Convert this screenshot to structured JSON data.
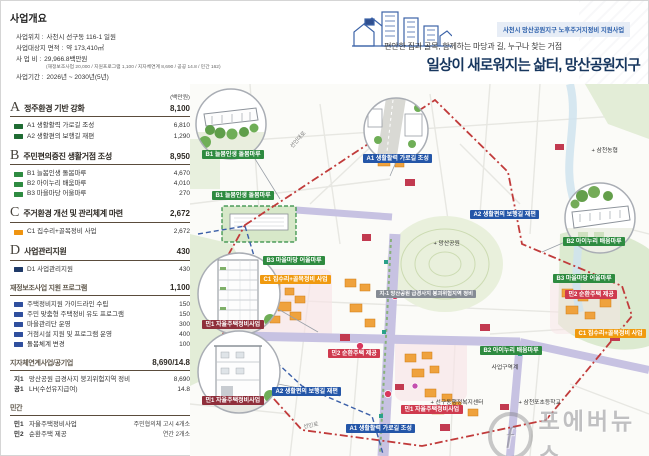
{
  "header": {
    "badge": "사천시 망산공원지구 노후주거지정비 지원사업",
    "subtitle": "편안한 집과 골목, 함께하는 마당과 길, 누구나 찾는 거점",
    "title": "일상이 새로워지는 삶터, 망산공원지구"
  },
  "overview": {
    "title": "사업개요",
    "rows": [
      {
        "label": "사업위치 :",
        "value": "사천시 선구동 116-1 일원"
      },
      {
        "label": "사업대상지 면적 :",
        "value": "약 173,410㎡"
      },
      {
        "label": "사 업 비 :",
        "value": "29,966.8백만원"
      },
      {
        "label": "사업기간 :",
        "value": "2026년 ~ 2030년(5년)"
      }
    ],
    "cost_note": "(재정보조사업 20,000 / 지원프로그램 1,100 / 지자체연계 8,690 / 공공 14.8 / 민간 162)"
  },
  "budget": {
    "unit": "(백만원)",
    "sections": [
      {
        "letter": "A",
        "title": "정주환경 기반 강화",
        "total": "8,100",
        "items": [
          {
            "label": "A1 생활활력 가로길 조성",
            "value": "6,810"
          },
          {
            "label": "A2 생활편의 보행길 재편",
            "value": "1,290"
          }
        ]
      },
      {
        "letter": "B",
        "title": "주민편의증진 생활거점 조성",
        "total": "8,950",
        "items": [
          {
            "label": "B1 늘봄인생 돌봄마루",
            "value": "4,670"
          },
          {
            "label": "B2 아이누리 배움마루",
            "value": "4,010"
          },
          {
            "label": "B3 마을마당 어울마루",
            "value": "270"
          }
        ]
      },
      {
        "letter": "C",
        "title": "주거환경 개선 및 관리체계 마련",
        "total": "2,672",
        "items": [
          {
            "label": "C1 집수리+골목정비 사업",
            "value": "2,672"
          }
        ]
      },
      {
        "letter": "D",
        "title": "사업관리지원",
        "total": "430",
        "items": [
          {
            "label": "D1 사업관리지원",
            "value": "430"
          }
        ]
      }
    ],
    "program": {
      "title": "재정보조사업 지원 프로그램",
      "total": "1,100",
      "items": [
        {
          "label": "주택정비지원 가이드라인 수립",
          "value": "150"
        },
        {
          "label": "주민 맞춤형 주택정비 유도 프로그램",
          "value": "150"
        },
        {
          "label": "마을관리단 운영",
          "value": "300"
        },
        {
          "label": "거점시설 지원 및 프로그램 운영",
          "value": "400"
        },
        {
          "label": "돌봄체계 변경",
          "value": "100"
        }
      ]
    },
    "linked": {
      "title": "지자체연계사업/공기업",
      "total": "8,690/14.8",
      "items": [
        {
          "code": "지1",
          "label": "망산공원 급경사지 붕괴위험지역 정비",
          "value": "8,690"
        },
        {
          "code": "공1",
          "label": "LH(수선유지급여)",
          "value": "14.8"
        }
      ]
    },
    "private": {
      "title": "민간",
      "items": [
        {
          "code": "민1",
          "label": "자율주택정비사업",
          "value": "주민협의체 고시 4개소"
        },
        {
          "code": "민2",
          "label": "순환주택 제공",
          "value": "연간 2개소"
        }
      ]
    }
  },
  "map": {
    "labels": [
      {
        "text": "B1 늘봄인생 돌봄마루"
      },
      {
        "text": "A1 생활활력 가로길 조성"
      },
      {
        "text": "B2 아이누리 배움마루"
      },
      {
        "text": "민1 자율주택정비사업"
      },
      {
        "text": "민1 자율주택정비사업"
      },
      {
        "text": "B1 늘봄인생 돌봄마루"
      },
      {
        "text": "B3 마을마당 어울마루"
      },
      {
        "text": "C1 집수리+골목정비 사업"
      },
      {
        "text": "민2 순환주택 제공"
      },
      {
        "text": "A2 생활편의 보행길 재편"
      },
      {
        "text": "A2 생활편의 보행길 재편"
      },
      {
        "text": "지-1 망산공원 급경사지 붕괴위험지역 정비"
      },
      {
        "text": "B3 마을마당 어울마루"
      },
      {
        "text": "민2 순환주택 제공"
      },
      {
        "text": "C1 집수리+골목정비 사업"
      },
      {
        "text": "B2 아이누리 배움마루"
      },
      {
        "text": "민1 자율주택정비사업"
      },
      {
        "text": "A1 생활활력 가로길 조성"
      },
      {
        "text": "+ 삼천농협"
      },
      {
        "text": "+ 망산공원"
      },
      {
        "text": "+ 선구동행정복지센터"
      },
      {
        "text": "+ 삼천포초등학교"
      },
      {
        "text": "사업구역계"
      },
      {
        "text": "선인대로"
      },
      {
        "text": "선인로"
      }
    ]
  },
  "watermark": {
    "logo": "ƒ",
    "text": "포에버뉴스"
  },
  "colors": {
    "label_green": "#2e8b40",
    "label_blue": "#2456a8",
    "label_orange": "#f09a0f",
    "label_red": "#cf3a4e",
    "label_darkred": "#8f2f3b",
    "label_gray": "#858b94",
    "title_navy": "#17365e",
    "badge_blue": "#2b5fab",
    "boundary_red": "#c13b3b",
    "boundary_blue": "#3b5fa8"
  }
}
